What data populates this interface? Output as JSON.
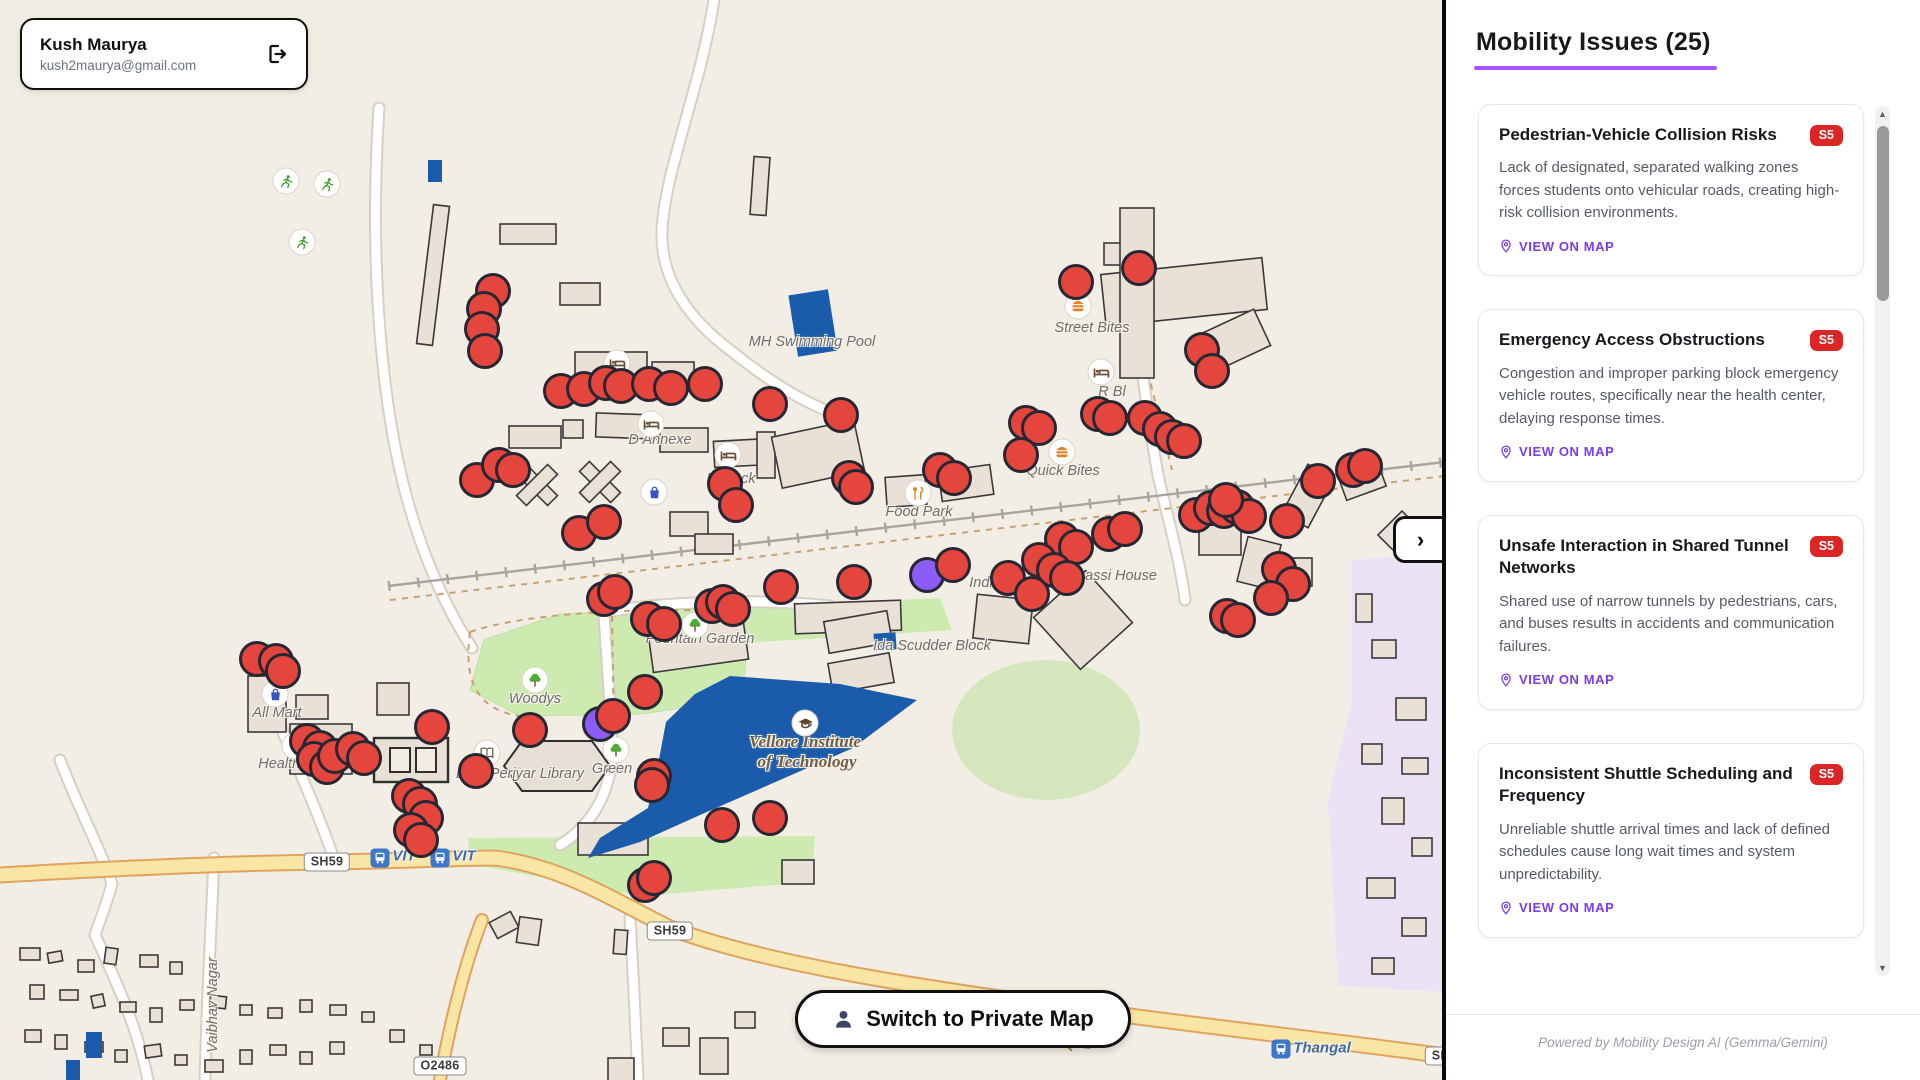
{
  "user_card": {
    "name": "Kush Maurya",
    "email": "kush2maurya@gmail.com"
  },
  "map": {
    "switch_button_label": "Switch to Private Map",
    "collapse_chevron": "›",
    "campus_label_line1": "Vellore Institute",
    "campus_label_line2": "of Technology",
    "labels": [
      {
        "text": "MH Swimming Pool",
        "x": 812,
        "y": 342,
        "cls": "poi"
      },
      {
        "text": "Street Bites",
        "x": 1092,
        "y": 328,
        "cls": "poi"
      },
      {
        "text": "R Bl",
        "x": 1112,
        "y": 392,
        "cls": "poi"
      },
      {
        "text": "Quick Bites",
        "x": 1063,
        "y": 471,
        "cls": "poi"
      },
      {
        "text": "Food Park",
        "x": 919,
        "y": 512,
        "cls": "poi"
      },
      {
        "text": "Lassi House",
        "x": 1117,
        "y": 576,
        "cls": "poi"
      },
      {
        "text": "Indian",
        "x": 989,
        "y": 583,
        "cls": "poi"
      },
      {
        "text": "Ida Scudder Block",
        "x": 932,
        "y": 646,
        "cls": "poi"
      },
      {
        "text": "Fountain Garden",
        "x": 700,
        "y": 639,
        "cls": "poi"
      },
      {
        "text": "Woodys",
        "x": 535,
        "y": 699,
        "cls": "poi"
      },
      {
        "text": "All Mart",
        "x": 277,
        "y": 713,
        "cls": "poi"
      },
      {
        "text": "Health Centre",
        "x": 303,
        "y": 764,
        "cls": "poi"
      },
      {
        "text": "EVR Periyar Library",
        "x": 520,
        "y": 774,
        "cls": "poi"
      },
      {
        "text": "Green",
        "x": 612,
        "y": 769,
        "cls": "poi"
      },
      {
        "text": "D Annexe",
        "x": 660,
        "y": 440,
        "cls": "poi"
      },
      {
        "text": "B Block",
        "x": 731,
        "y": 479,
        "cls": "poi"
      },
      {
        "text": "Vaibhav Nagar",
        "x": 213,
        "y": 1005,
        "cls": "poi rot"
      },
      {
        "text": "VIT",
        "x": 404,
        "y": 856,
        "cls": "blue"
      },
      {
        "text": "VIT",
        "x": 464,
        "y": 856,
        "cls": "blue"
      },
      {
        "text": "Thangal",
        "x": 1322,
        "y": 1048,
        "cls": "blue"
      }
    ],
    "road_badges": [
      {
        "text": "SH59",
        "x": 327,
        "y": 862
      },
      {
        "text": "SH59",
        "x": 670,
        "y": 931
      },
      {
        "text": "O2486",
        "x": 440,
        "y": 1066
      },
      {
        "text": "SH59",
        "x": 1448,
        "y": 1056
      }
    ],
    "bus_stops": [
      {
        "x": 380,
        "y": 858
      },
      {
        "x": 440,
        "y": 858
      },
      {
        "x": 1281,
        "y": 1049
      }
    ],
    "pois": [
      {
        "type": "burger",
        "x": 1078,
        "y": 306
      },
      {
        "type": "burger",
        "x": 1062,
        "y": 452
      },
      {
        "type": "fork",
        "x": 918,
        "y": 493
      },
      {
        "type": "tree",
        "x": 535,
        "y": 680
      },
      {
        "type": "tree",
        "x": 695,
        "y": 625
      },
      {
        "type": "tree",
        "x": 616,
        "y": 750
      },
      {
        "type": "bed",
        "x": 617,
        "y": 363
      },
      {
        "type": "bed",
        "x": 651,
        "y": 424
      },
      {
        "type": "bed",
        "x": 728,
        "y": 455
      },
      {
        "type": "bed",
        "x": 1101,
        "y": 372
      },
      {
        "type": "bag",
        "x": 654,
        "y": 492
      },
      {
        "type": "bag",
        "x": 275,
        "y": 694
      },
      {
        "type": "book",
        "x": 487,
        "y": 753
      },
      {
        "type": "cross",
        "x": 295,
        "y": 746
      },
      {
        "type": "cap",
        "x": 805,
        "y": 723
      },
      {
        "type": "runner",
        "x": 286,
        "y": 181
      },
      {
        "type": "runner",
        "x": 327,
        "y": 184
      },
      {
        "type": "runner",
        "x": 302,
        "y": 242
      }
    ],
    "markers_purple": [
      [
        927,
        575
      ],
      [
        600,
        724
      ]
    ],
    "markers_red": [
      [
        493,
        291
      ],
      [
        484,
        309
      ],
      [
        482,
        329
      ],
      [
        485,
        351
      ],
      [
        561,
        391
      ],
      [
        584,
        389
      ],
      [
        606,
        383
      ],
      [
        621,
        386
      ],
      [
        649,
        384
      ],
      [
        671,
        388
      ],
      [
        705,
        384
      ],
      [
        770,
        404
      ],
      [
        841,
        415
      ],
      [
        1076,
        282
      ],
      [
        1139,
        268
      ],
      [
        1026,
        423
      ],
      [
        1039,
        428
      ],
      [
        1021,
        455
      ],
      [
        1098,
        414
      ],
      [
        1110,
        418
      ],
      [
        1145,
        418
      ],
      [
        1160,
        429
      ],
      [
        1172,
        437
      ],
      [
        1184,
        441
      ],
      [
        1202,
        350
      ],
      [
        1212,
        371
      ],
      [
        477,
        480
      ],
      [
        499,
        465
      ],
      [
        513,
        470
      ],
      [
        579,
        533
      ],
      [
        604,
        522
      ],
      [
        725,
        484
      ],
      [
        736,
        505
      ],
      [
        849,
        478
      ],
      [
        856,
        487
      ],
      [
        940,
        470
      ],
      [
        954,
        478
      ],
      [
        1196,
        515
      ],
      [
        1211,
        508
      ],
      [
        1224,
        511
      ],
      [
        1237,
        507
      ],
      [
        1249,
        516
      ],
      [
        1287,
        521
      ],
      [
        1226,
        500
      ],
      [
        1318,
        481
      ],
      [
        1353,
        470
      ],
      [
        1365,
        466
      ],
      [
        1279,
        569
      ],
      [
        1293,
        584
      ],
      [
        1271,
        598
      ],
      [
        1227,
        616
      ],
      [
        1238,
        620
      ],
      [
        1062,
        539
      ],
      [
        1076,
        547
      ],
      [
        1109,
        534
      ],
      [
        1125,
        529
      ],
      [
        1039,
        560
      ],
      [
        1054,
        570
      ],
      [
        1067,
        578
      ],
      [
        953,
        565
      ],
      [
        1008,
        578
      ],
      [
        1032,
        594
      ],
      [
        781,
        587
      ],
      [
        854,
        582
      ],
      [
        604,
        599
      ],
      [
        615,
        592
      ],
      [
        648,
        619
      ],
      [
        664,
        624
      ],
      [
        712,
        606
      ],
      [
        723,
        602
      ],
      [
        733,
        609
      ],
      [
        257,
        659
      ],
      [
        276,
        661
      ],
      [
        283,
        671
      ],
      [
        307,
        741
      ],
      [
        320,
        748
      ],
      [
        314,
        759
      ],
      [
        327,
        767
      ],
      [
        335,
        756
      ],
      [
        353,
        749
      ],
      [
        364,
        758
      ],
      [
        432,
        727
      ],
      [
        409,
        796
      ],
      [
        420,
        804
      ],
      [
        426,
        818
      ],
      [
        411,
        830
      ],
      [
        421,
        840
      ],
      [
        476,
        771
      ],
      [
        530,
        730
      ],
      [
        645,
        692
      ],
      [
        613,
        716
      ],
      [
        654,
        776
      ],
      [
        652,
        785
      ],
      [
        722,
        825
      ],
      [
        770,
        818
      ],
      [
        645,
        885
      ],
      [
        654,
        878
      ]
    ]
  },
  "sidebar": {
    "title": "Mobility Issues (25)",
    "accent_color": "#a855f7",
    "severity_color": "#dc2626",
    "cards": [
      {
        "title": "Pedestrian-Vehicle Collision Risks",
        "severity": "S5",
        "description": "Lack of designated, separated walking zones forces students onto vehicular roads, creating high-risk collision environments.",
        "link": "VIEW ON MAP"
      },
      {
        "title": "Emergency Access Obstructions",
        "severity": "S5",
        "description": "Congestion and improper parking block emergency vehicle routes, specifically near the health center, delaying response times.",
        "link": "VIEW ON MAP"
      },
      {
        "title": "Unsafe Interaction in Shared Tunnel Networks",
        "severity": "S5",
        "description": "Shared use of narrow tunnels by pedestrians, cars, and buses results in accidents and communication failures.",
        "link": "VIEW ON MAP"
      },
      {
        "title": "Inconsistent Shuttle Scheduling and Frequency",
        "severity": "S5",
        "description": "Unreliable shuttle arrival times and lack of defined schedules cause long wait times and system unpredictability.",
        "link": "VIEW ON MAP"
      }
    ],
    "footer": "Powered by Mobility Design AI (Gemma/Gemini)"
  }
}
